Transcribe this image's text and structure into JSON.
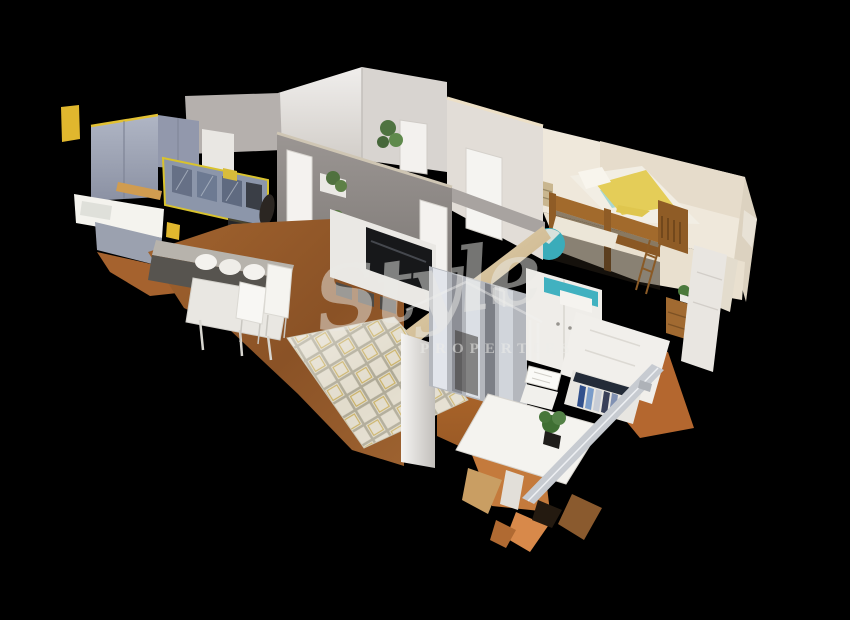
{
  "scene": {
    "type": "3d-dollhouse-scan",
    "subject": "cutaway top-oblique 3D scan of a small apartment on black background",
    "background": "#000000"
  },
  "watermark": {
    "script": "Style",
    "sub": "PROPERTIES",
    "house_icon": "house-outline-icon"
  },
  "rooms": [
    "kitchen",
    "dining-area",
    "living-room",
    "hallway",
    "kids-bedroom",
    "bedroom",
    "balcony"
  ],
  "palette": {
    "background": "#000000",
    "grey_wall": "#8e8987",
    "white_wall": "#ece9e5",
    "cut_edge_cream": "#d9c8a5",
    "kitchen_cabinet_blue_grey": "#9aa2b6",
    "accent_yellow": "#e2c133",
    "wood_floor": "#96592b",
    "terracotta_floor": "#b4672f",
    "bunkbed_wood": "#9c682c",
    "bedding_yellow": "#e4cd58",
    "teal_accent": "#3fb0bd",
    "rug_cream": "#ded7c5",
    "rug_gold": "#c1a44b",
    "tv_black": "#17181a"
  }
}
